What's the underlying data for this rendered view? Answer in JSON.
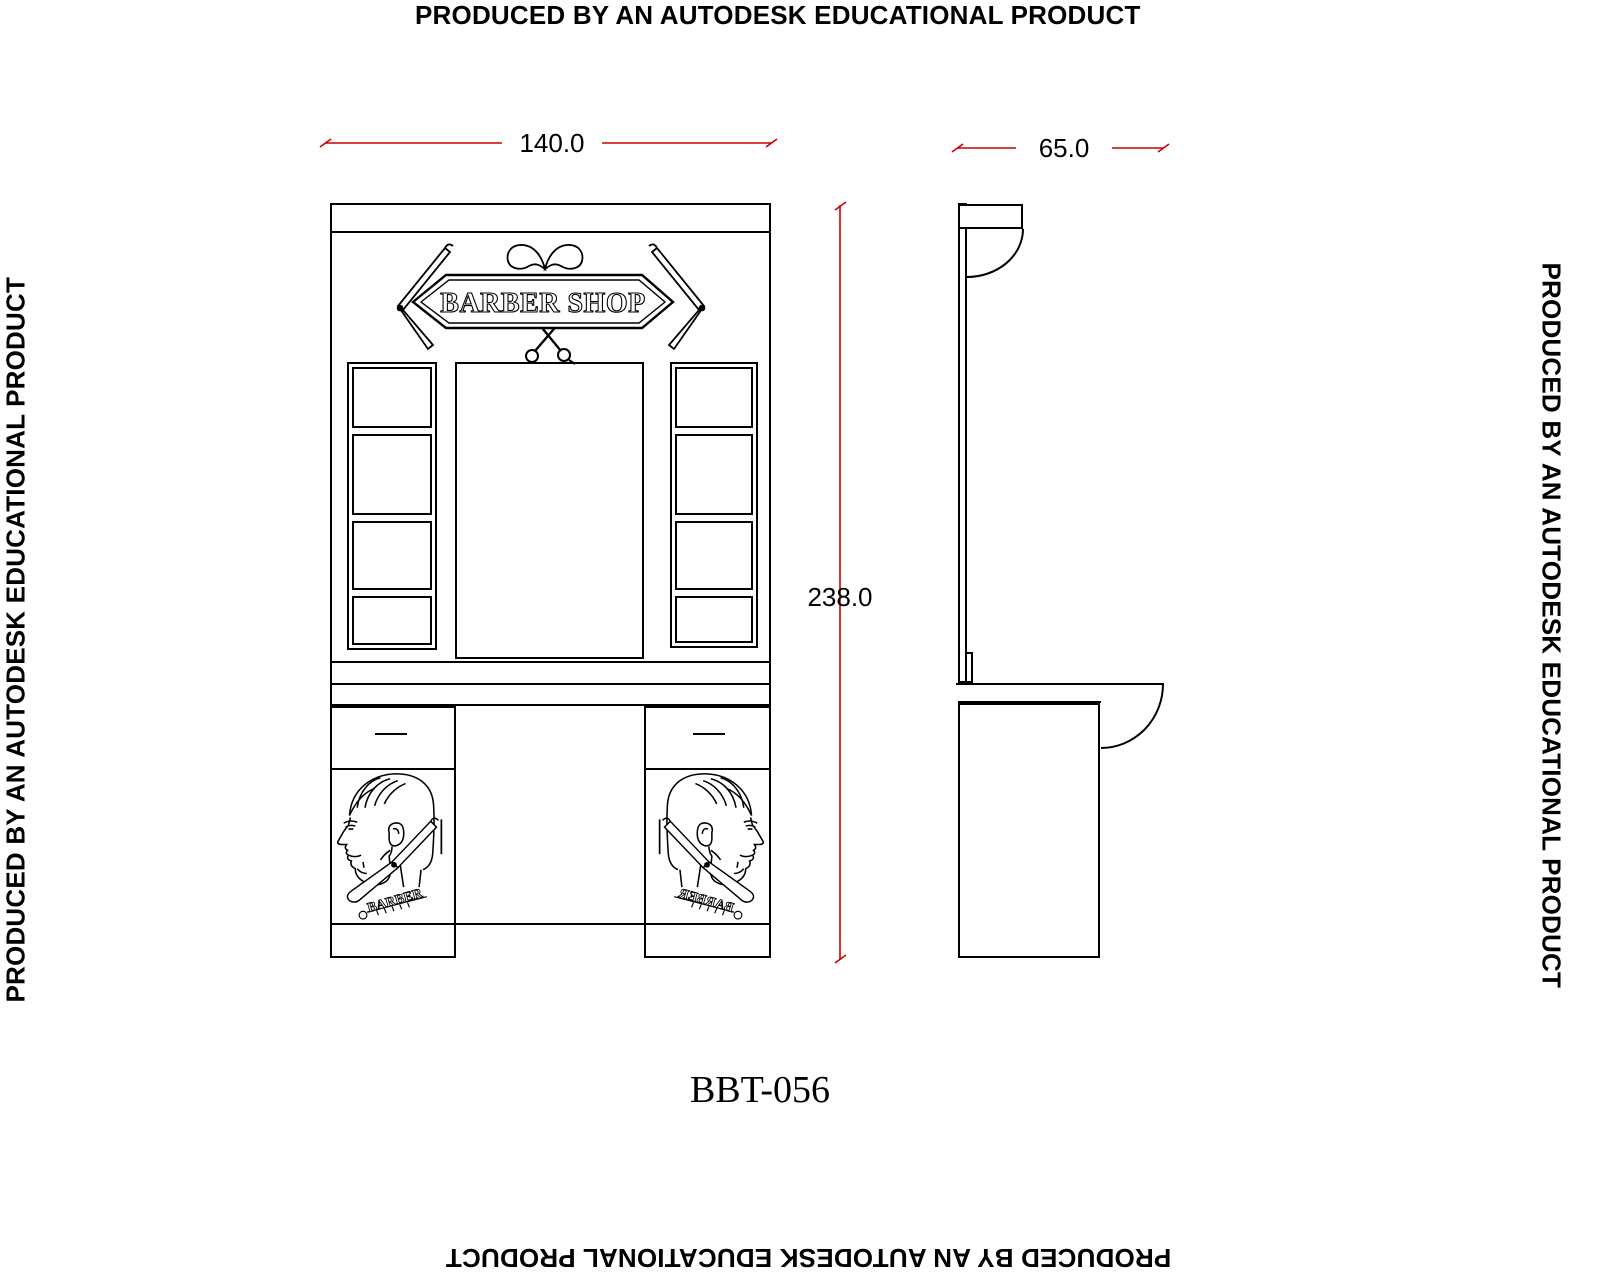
{
  "edge_notices": {
    "top": "PRODUCED BY AN AUTODESK EDUCATIONAL PRODUCT",
    "left": "PRODUCED BY AN AUTODESK EDUCATIONAL PRODUCT",
    "right": "PRODUCED BY AN AUTODESK EDUCATIONAL PRODUCT",
    "bottom": "PRODUCED BY AN AUTODESK EDUCATIONAL PRODUCT"
  },
  "drawing": {
    "model_number": "BBT-056",
    "sign_text": "BARBER SHOP",
    "door_label": "BARBER",
    "dimensions": {
      "front_width": "140.0",
      "side_depth": "65.0",
      "overall_height": "238.0"
    },
    "icons": [
      "mustache-icon",
      "scissors-icon",
      "straight-razor-icon",
      "barber-head-icon",
      "comb-icon"
    ],
    "colors": {
      "line": "#000000",
      "dimension_line": "#cc0000",
      "background": "#ffffff"
    }
  }
}
